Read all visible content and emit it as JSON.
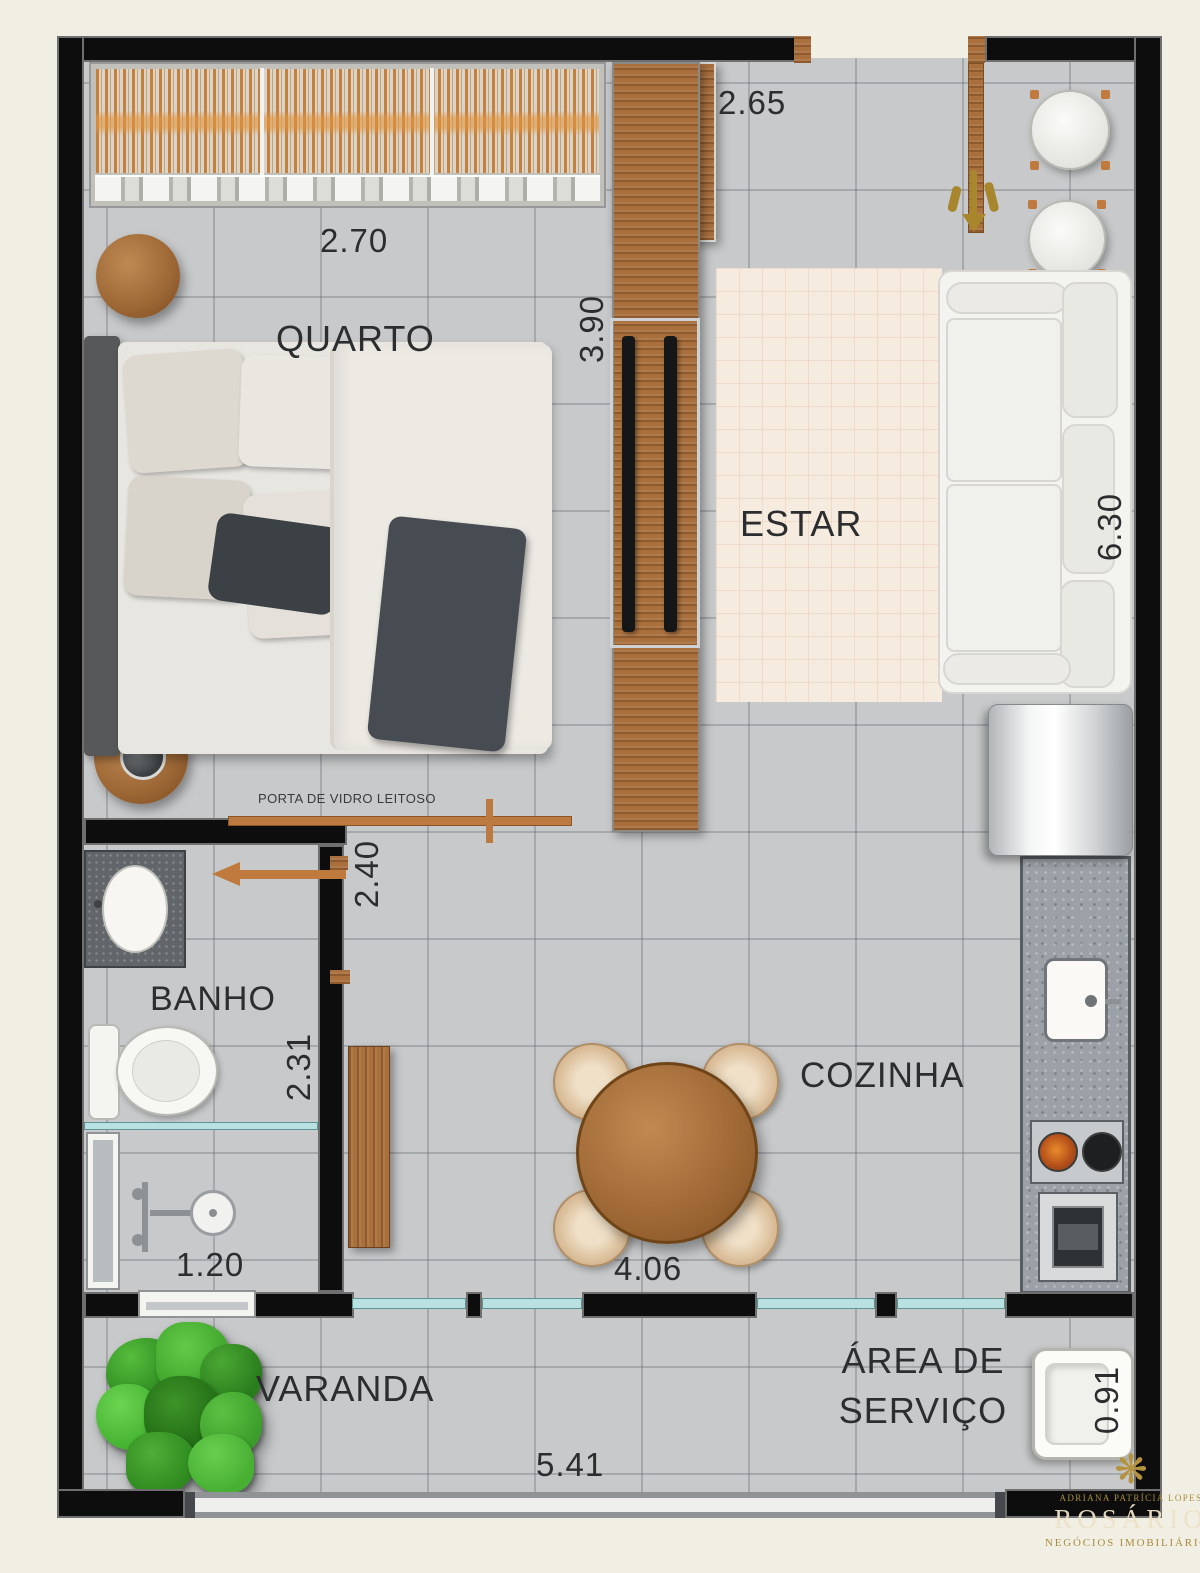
{
  "plan": {
    "labels": {
      "quarto": "QUARTO",
      "estar": "ESTAR",
      "banho": "BANHO",
      "cozinha": "COZINHA",
      "varanda": "VARANDA",
      "area_servico_1": "ÁREA DE",
      "area_servico_2": "SERVIÇO"
    },
    "dims": {
      "hall_width": "2.65",
      "quarto_width": "2.70",
      "quarto_depth": "3.90",
      "estar_depth": "6.30",
      "quarto_door": "2.40",
      "banho_depth": "2.31",
      "banho_width": "1.20",
      "cozinha_width": "4.06",
      "varanda_width": "5.41",
      "servico_depth": "0.91"
    },
    "notes": {
      "sliding_door": "PORTA DE VIDRO LEITOSO"
    },
    "colors": {
      "wall": "#0d0d0d",
      "floor_tile": "#c7c9ca",
      "wood": "#a9703d",
      "rug": "#f6ebdf",
      "glass": "#b9e1e1",
      "gold": "#b5923f"
    }
  },
  "watermark": {
    "ornament": "❋",
    "agent": "ADRIANA PATRÍCIA LOPES",
    "brand": "ROSÁRIO",
    "tagline": "NEGÓCIOS IMOBILIÁRIOS"
  }
}
